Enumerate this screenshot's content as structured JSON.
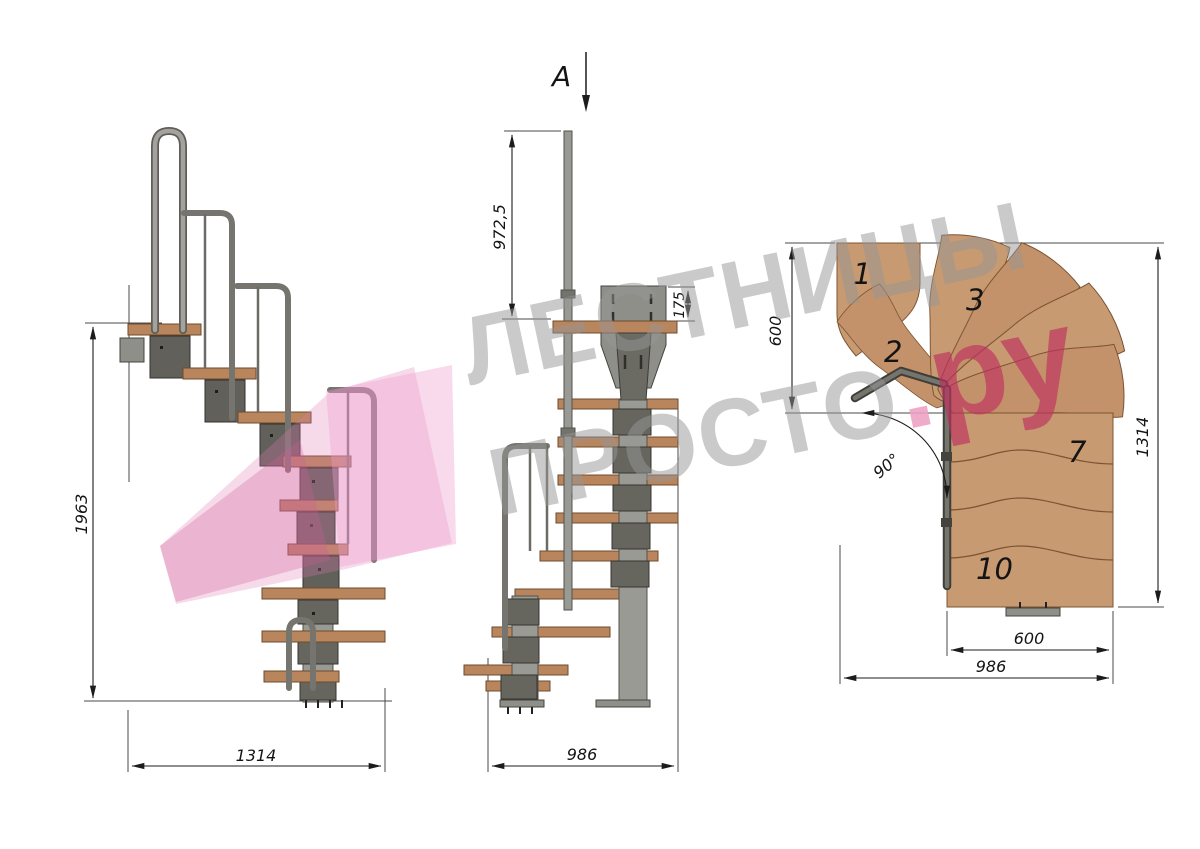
{
  "section_marker": {
    "label": "A"
  },
  "side_view": {
    "dim_height": "1963",
    "dim_width": "1314"
  },
  "front_view": {
    "dim_rail_height": "972,5",
    "dim_plate_offset": "175",
    "dim_width": "986"
  },
  "plan_view": {
    "dim_flight_width": "600",
    "dim_length": "1314",
    "dim_step_width": "600",
    "dim_overall_width": "986",
    "dim_turn_angle": "90°",
    "tread_labels": [
      "1",
      "2",
      "3",
      "7",
      "10"
    ]
  },
  "watermark": {
    "line1": "ЛЕСТНИЦЫ",
    "line2": "ПРОСТО",
    "dot": ".",
    "suffix": "ру"
  },
  "colors": {
    "wood_plan": "#c79a71",
    "wood_side": "#b8855c",
    "metal_light": "#9a9a94",
    "metal_dark": "#61605a",
    "watermark_gray": "#999999",
    "watermark_pink": "#be305f",
    "watermark_pink_light": "#eca0c3",
    "watermark_arrow_pink": "#e07ab3"
  }
}
